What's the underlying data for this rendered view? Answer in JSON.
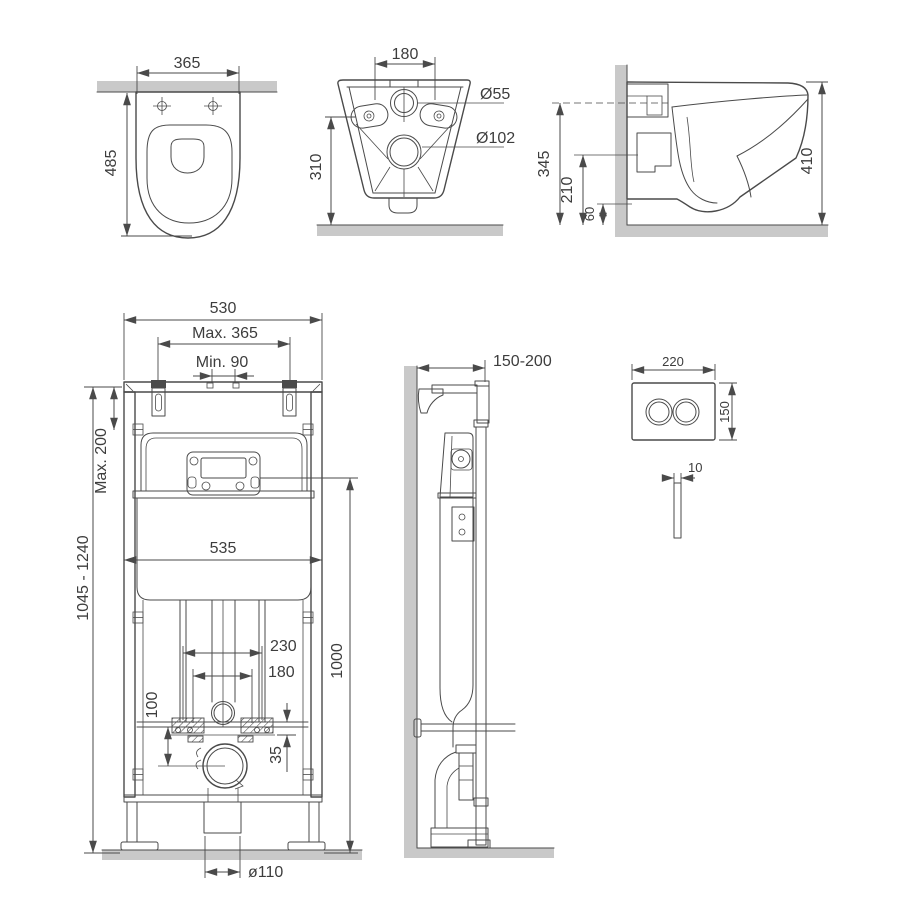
{
  "title": "Wall-hung toilet and installation frame dimensional drawing",
  "colors": {
    "line": "#4a4a4a",
    "surface": "#c9c9c9",
    "text": "#3d3d3d",
    "bg": "#ffffff"
  },
  "views": {
    "toilet_top": {
      "name": "toilet top view",
      "dims": {
        "width": "365",
        "depth": "485"
      }
    },
    "toilet_back": {
      "name": "toilet back view",
      "dims": {
        "bolt_spacing": "180",
        "inlet_diameter": "Ø55",
        "outlet_diameter": "Ø102",
        "height": "310"
      }
    },
    "toilet_side": {
      "name": "toilet side view",
      "dims": {
        "wall_height": "345",
        "outlet_height": "210",
        "clearance": "60",
        "total_height": "410"
      }
    },
    "frame_front": {
      "name": "installation frame front view",
      "dims": {
        "width": "530",
        "stud_max": "Max. 365",
        "stud_min": "Min. 90",
        "top_adjust_max": "Max. 200",
        "height_range": "1045 - 1240",
        "cistern_width": "535",
        "fixing_spacing": "230",
        "pipe_spacing": "180",
        "inlet_offset": "100",
        "bracket_offset": "35",
        "flush_pipe_height": "1000",
        "outlet_diameter": "ø110"
      }
    },
    "frame_side": {
      "name": "installation frame side view",
      "dims": {
        "wall_distance": "150-200"
      }
    },
    "flush_plate": {
      "name": "flush plate",
      "dims": {
        "width": "220",
        "height": "150",
        "thickness": "10"
      }
    }
  }
}
